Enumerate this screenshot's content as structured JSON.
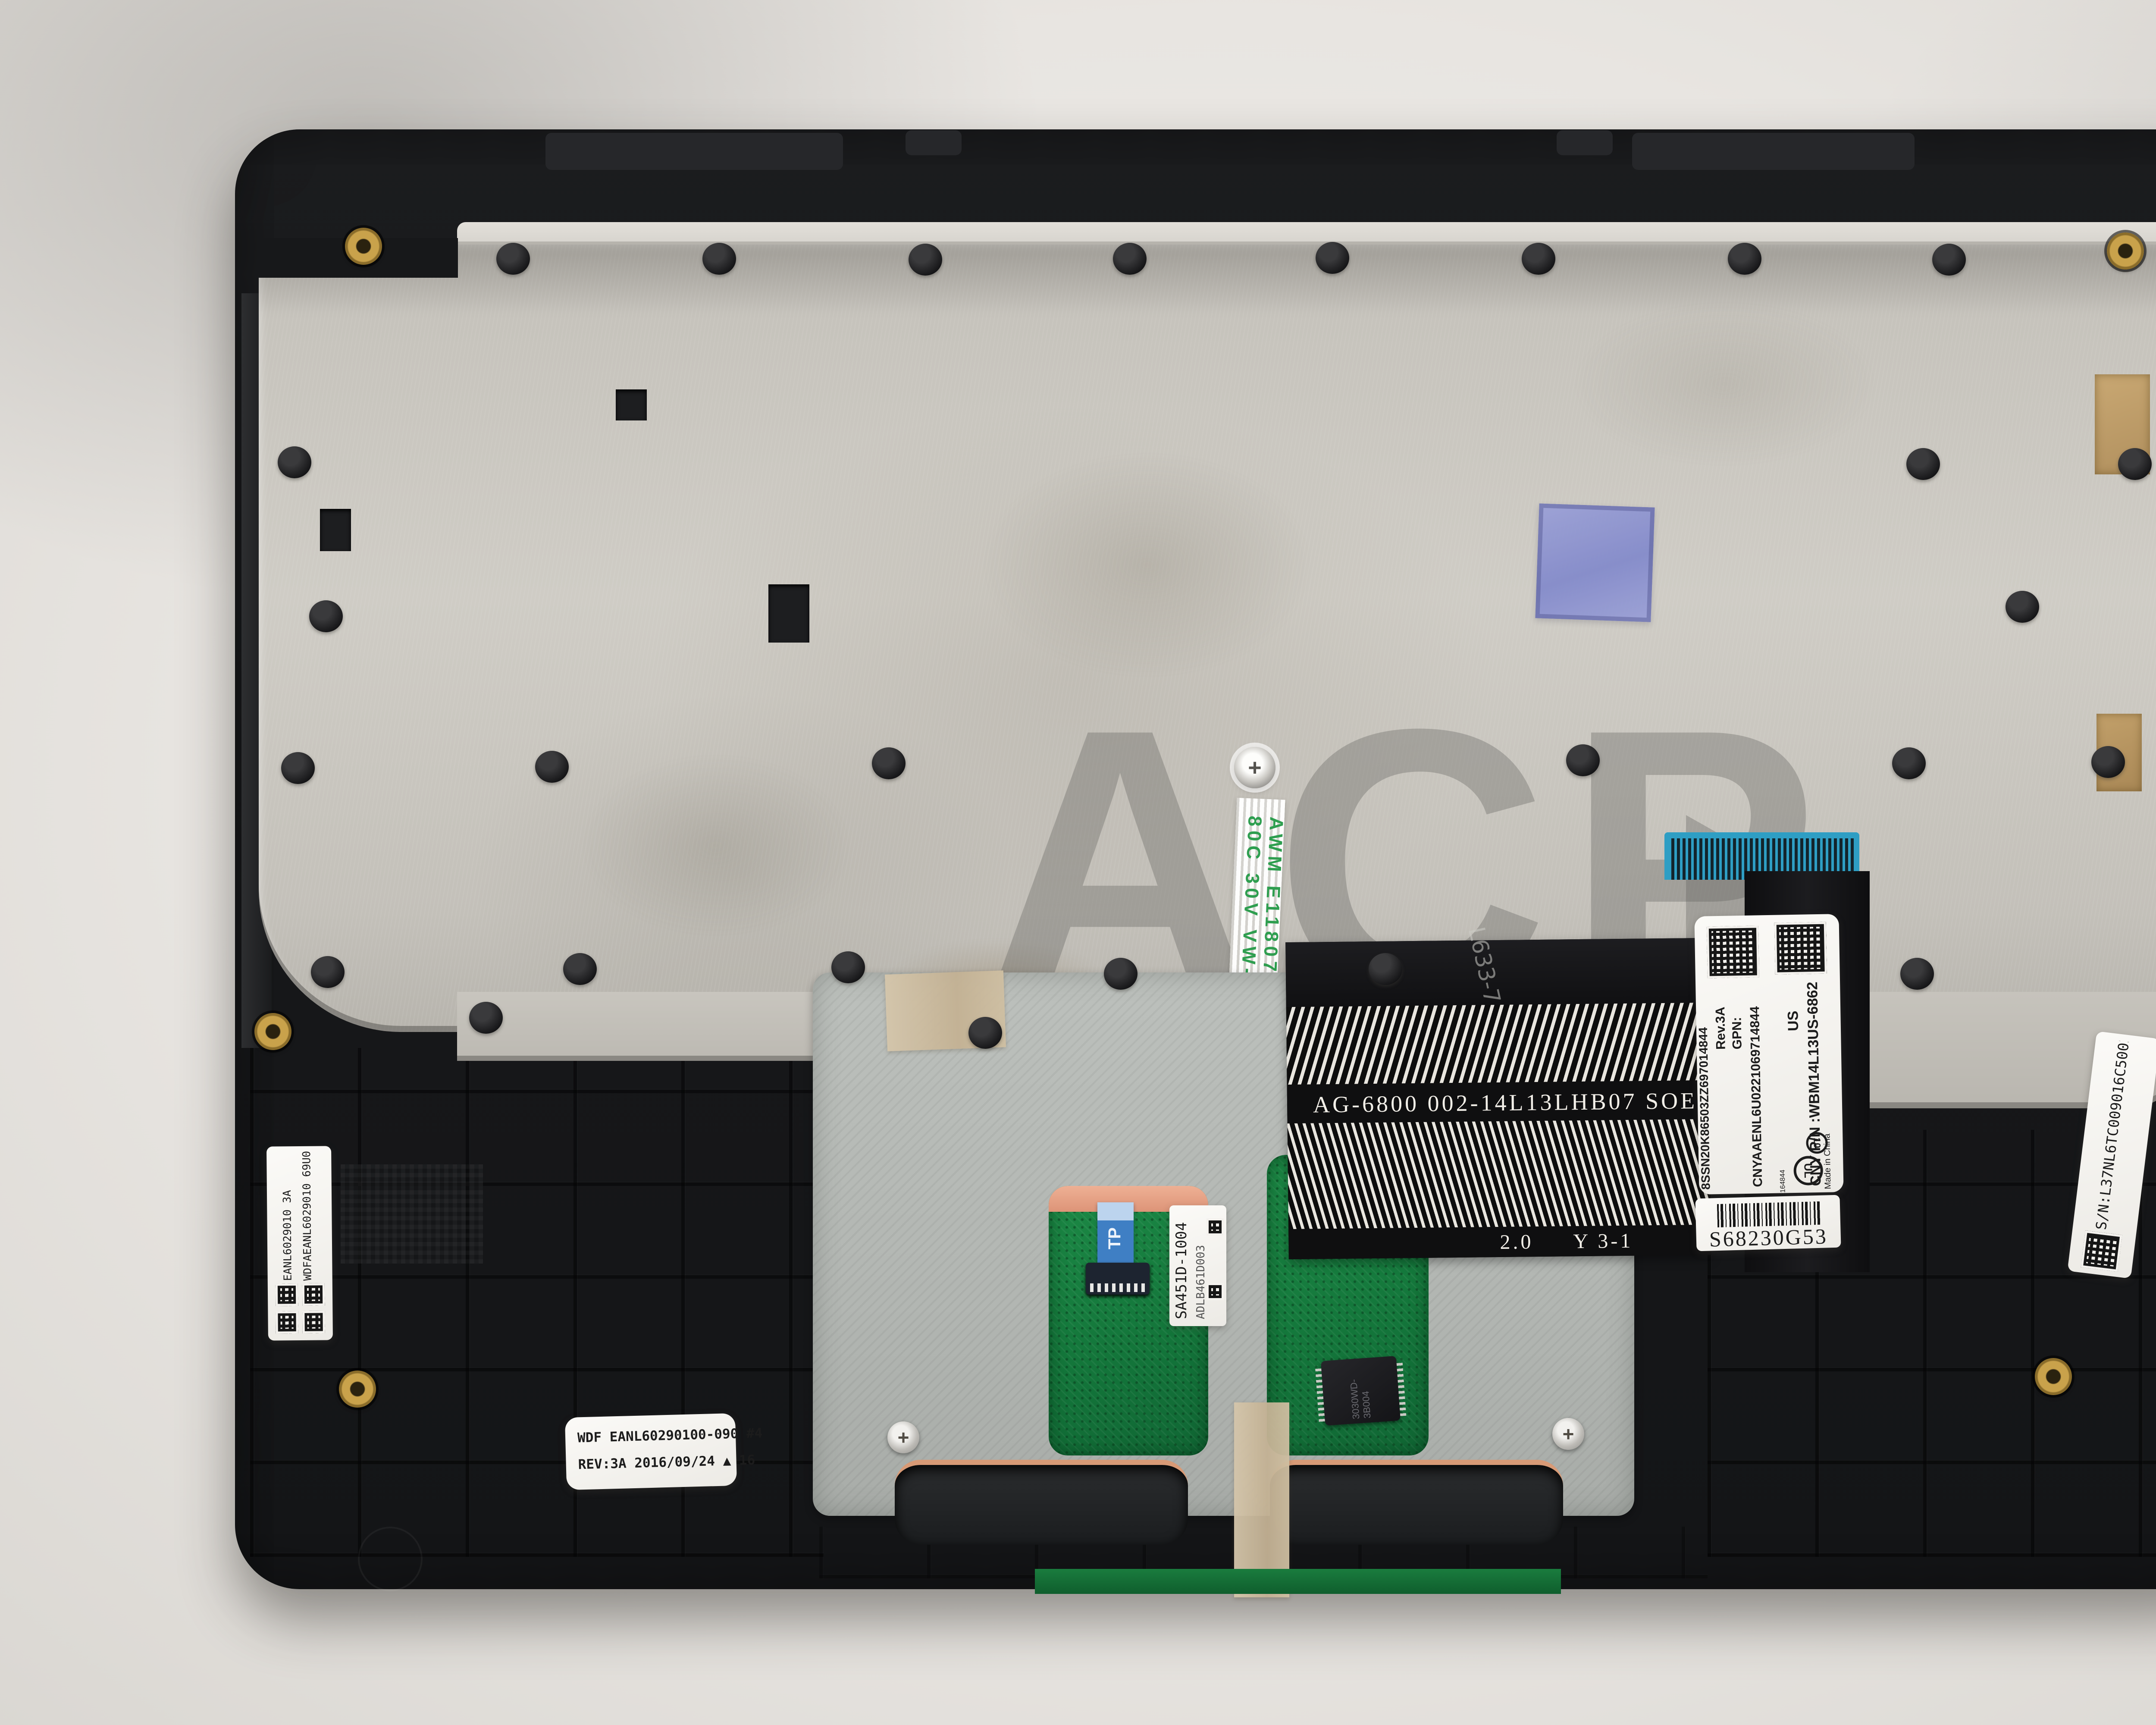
{
  "scene": {
    "subject": "laptop palmrest keyboard assembly, underside view",
    "watermark": "ACP"
  },
  "labels": {
    "part_label": {
      "pn_line": "CNY P/N :WBM14L13US-6862  WBM14L1",
      "region": "US",
      "code1": "CNYAAENL6U0221069714844",
      "gpn": "GPN:",
      "rev": "Rev.3A",
      "code2": "8SSN20K86503ZZ697014844",
      "made_in": "Made in China",
      "ul_mark": "cULus",
      "ul_code": "E164844",
      "recycle_mark": "10"
    },
    "service_tag": {
      "text": "S68230G53"
    },
    "serial_label": {
      "text": "S/N:L37NL6TC009016C5002184"
    },
    "left_mold_label": {
      "line1": "WDFAEANL6029010 69U00840",
      "line2": "EANL6029010  3A"
    },
    "date_label": {
      "line1": "WDF EANL60290100-090 #4",
      "line2": "REV:3A 2016/09/24 ▲ 16"
    },
    "touchpad_label": {
      "outer": "SA451D-1004",
      "inner": "ADLB461D003"
    },
    "tp_flex_tab": "TP",
    "chip_marking": "3030WD-3B004"
  },
  "cables": {
    "keyboard_ffc_marking": "AWM E118077-K 2896 80C 30V VW-1",
    "keyboard_ffc_marking_2": "E118077-K  2896",
    "touchpad_cable": {
      "print_line": "AG-6800   002-14L13LHB07 SOE-N",
      "thickness": "2.0",
      "code": "Y 3-1",
      "handwritten": "L633-7"
    }
  },
  "colors": {
    "chassis_black": "#17181a",
    "plate_silver": "#cfccc5",
    "tape_blue": "#8289cb",
    "pcb_green": "#13753a",
    "bracket_silver": "#b2b6b2",
    "copper": "#dd9478",
    "connector_blue": "#2e9ec4",
    "gold_insert": "#c9a24b",
    "background": "#e8e5e1"
  }
}
